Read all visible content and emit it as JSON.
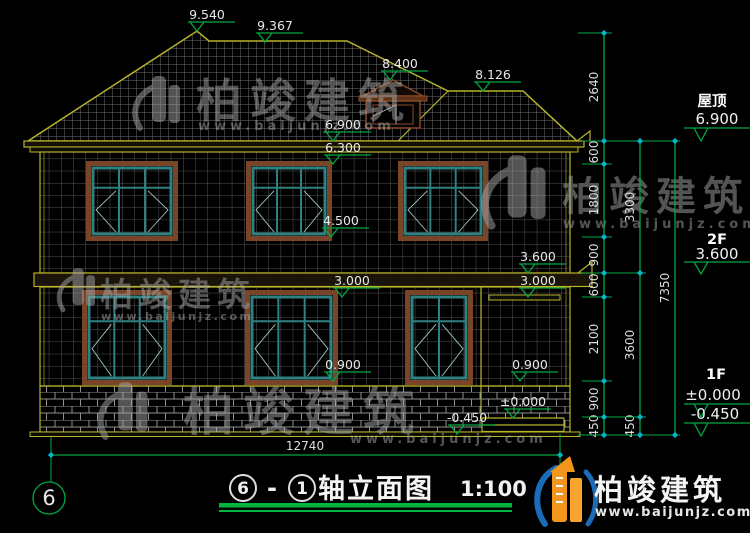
{
  "levels": {
    "l9540": "9.540",
    "l9367": "9.367",
    "l8400": "8.400",
    "l8126": "8.126",
    "l6900": "6.900",
    "l6300": "6.300",
    "l4500": "4.500",
    "l3600": "3.600",
    "l3000": "3.000",
    "l0900": "0.900",
    "l0000": "±0.000",
    "lm0450": "-0.450"
  },
  "dims": {
    "v2640": "2640",
    "v600": "600",
    "v1800": "1800",
    "v900": "900",
    "v2100": "2100",
    "v450": "450",
    "v3300": "3300",
    "v3600": "3600",
    "v7350": "7350",
    "total": "12740"
  },
  "right_labels": {
    "roof": "屋顶",
    "roof_value": "6.900",
    "f2": "2F",
    "f2_value": "3.600",
    "f1": "1F",
    "f1_value": "±0.000",
    "ground_value": "-0.450"
  },
  "axis": {
    "left_bubble": "6"
  },
  "title": {
    "axis_a": "6",
    "sep": "-",
    "axis_b": "1",
    "name": "轴立面图",
    "scale": "1:100"
  },
  "watermark": {
    "brand": "柏竣建筑",
    "url": "www.baijunjz.com"
  },
  "logo": {
    "brand": "柏竣建筑",
    "url": "www.baijunjz.com"
  },
  "colors": {
    "dimension_green": "#00a843",
    "outline_yellow": "#b8b42c",
    "tick_cyan": "#00b8c8",
    "window_teal": "#2f8080",
    "frame_brown": "#7a4527",
    "logo_orange": "#f2951d",
    "logo_blue": "#1b6cb8",
    "title_underline_green": "#00b43c"
  }
}
